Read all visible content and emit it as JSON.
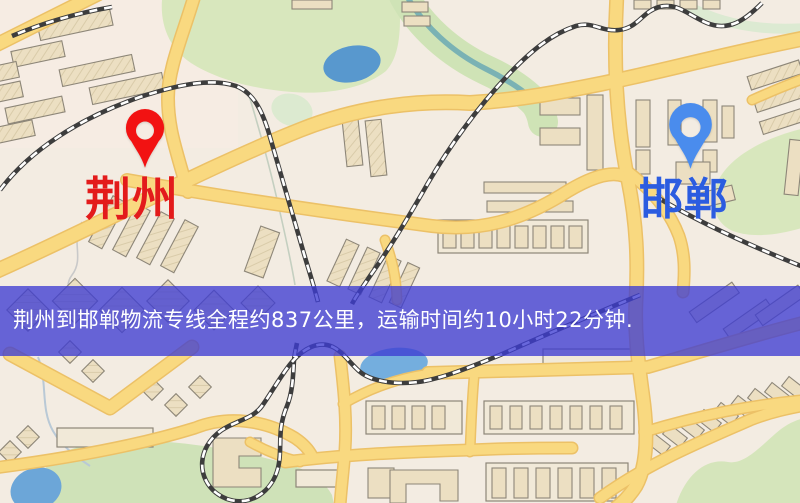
{
  "banner": {
    "text": "荆州到邯郸物流专线全程约837公里，运输时间约10小时22分钟.",
    "background_color": "#3e3cd2",
    "background_opacity": 0.78,
    "text_color": "#ffffff"
  },
  "markers": {
    "origin": {
      "label": "荆州",
      "label_color": "#e31b1b",
      "pin_color": "#f21212"
    },
    "destination": {
      "label": "邯郸",
      "label_color": "#2b5ce0",
      "pin_color": "#4a8ced"
    }
  },
  "route": {
    "origin_city": "荆州",
    "destination_city": "邯郸",
    "distance_km": 837,
    "duration_text": "10小时22分钟"
  },
  "map_colors": {
    "background": "#f3ece2",
    "road_fill": "#f9d980",
    "road_casing": "#ecc167",
    "building_fill": "#ecdfc2",
    "park_green": "#d8e7bd",
    "water_blue": "#5e9ed2",
    "railway_dark": "#3d3d3d"
  }
}
